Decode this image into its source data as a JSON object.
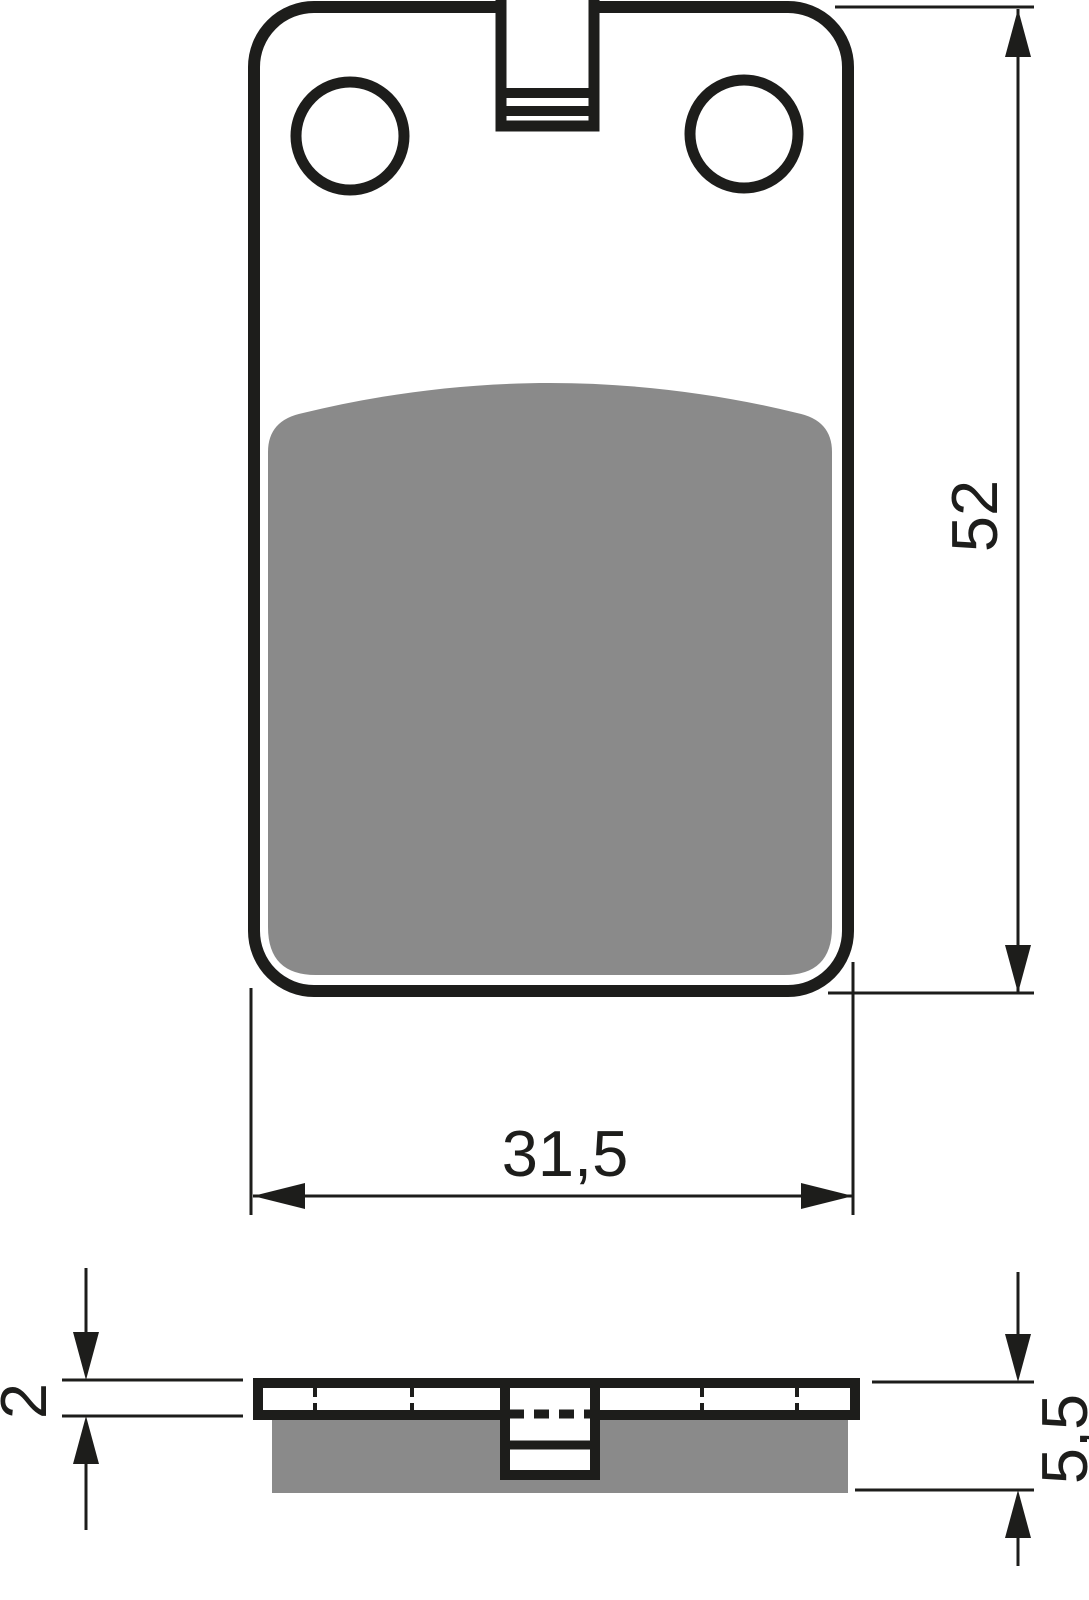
{
  "drawing": {
    "description": "brake pad technical drawing, front view and side profile with dimensions",
    "colors": {
      "line": "#1d1d1b",
      "pad_material": "#8a8a8a",
      "background": "#ffffff"
    },
    "dimensions": {
      "pad_height": {
        "value": "52"
      },
      "pad_width": {
        "value": "31,5"
      },
      "backplate_thickness": {
        "value": "2"
      },
      "total_thickness": {
        "value": "5,5"
      }
    }
  }
}
